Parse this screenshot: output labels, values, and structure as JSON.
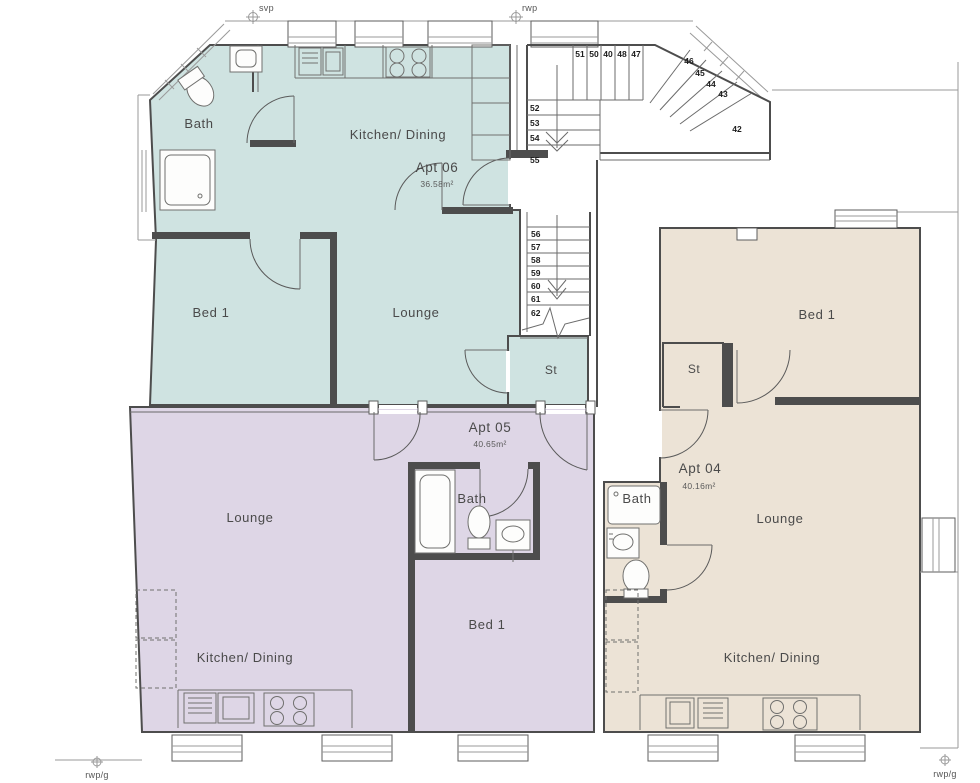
{
  "colors": {
    "apt06_fill": "#cfe3e1",
    "apt05_fill": "#ded6e6",
    "apt04_fill": "#ece3d6",
    "wall": "#4d4d4d",
    "label_text": "#4a4a4a"
  },
  "apartments": [
    {
      "name": "Apt 06",
      "area": "36.58m²",
      "rooms": {
        "bath": "Bath",
        "kitchen": "Kitchen/ Dining",
        "bed": "Bed 1",
        "lounge": "Lounge",
        "store": "St"
      }
    },
    {
      "name": "Apt 05",
      "area": "40.65m²",
      "rooms": {
        "lounge": "Lounge",
        "kitchen": "Kitchen/ Dining",
        "bath": "Bath",
        "bed": "Bed 1"
      }
    },
    {
      "name": "Apt 04",
      "area": "40.16m²",
      "rooms": {
        "bed": "Bed 1",
        "store": "St",
        "bath": "Bath",
        "lounge": "Lounge",
        "kitchen": "Kitchen/ Dining"
      }
    }
  ],
  "stairs": {
    "upper_run": [
      "51",
      "50",
      "40",
      "48",
      "47"
    ],
    "winders": [
      "46",
      "45",
      "44",
      "43",
      "42"
    ],
    "mid_run": [
      "52",
      "53",
      "54",
      "55"
    ],
    "lower_run": [
      "56",
      "57",
      "58",
      "59",
      "60",
      "61",
      "62"
    ]
  },
  "annotations": {
    "svp": "svp",
    "rwp": "rwp",
    "rwp_g_left": "rwp/g",
    "rwp_g_right": "rwp/g"
  }
}
